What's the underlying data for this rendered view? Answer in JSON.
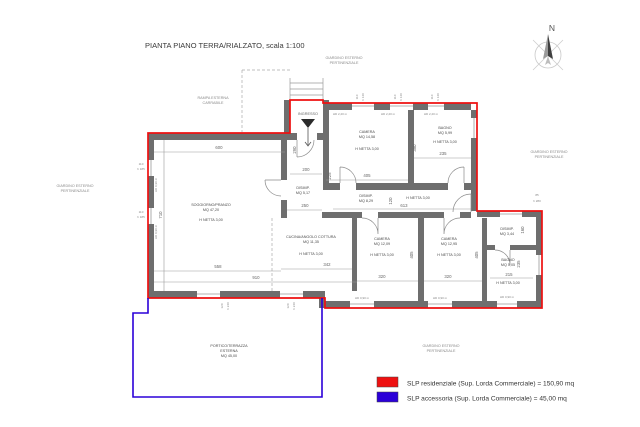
{
  "title": "PIANTA PIANO TERRA/RIALZATO, scala 1:100",
  "compass": {
    "n": "N"
  },
  "exterior": {
    "rampa": {
      "line1": "RAMPA ESTERNA",
      "line2": "CARRABILE"
    },
    "ingresso": "INGRESSO",
    "giardino": {
      "line1": "GIARDINO ESTERNO",
      "line2": "PERTINENZIALE"
    }
  },
  "rooms": {
    "soggiorno": {
      "name": "SOGGIORNO/PRANZO",
      "area": "MQ 47,20",
      "height": "H NETTA 3,00"
    },
    "cucina": {
      "name": "CUCINA/ANGOLO COTTURA",
      "area": "MQ 11,35",
      "height": "H NETTA 3,00"
    },
    "disimp1": {
      "name": "DISIMP.",
      "area": "MQ 5,17"
    },
    "camera_nord": {
      "name": "CAMERA",
      "area": "MQ 14,58",
      "height": "H NETTA 3,00"
    },
    "bagno_nord": {
      "name": "BAGNO",
      "area": "MQ 5,99",
      "height": "H NETTA 3,00"
    },
    "disimp2": {
      "name": "DISIMP.",
      "area": "MQ 8,29",
      "height": "H NETTA 3,00"
    },
    "camera_so": {
      "name": "CAMERA",
      "area": "MQ 12,09",
      "height": "H NETTA 3,00"
    },
    "camera_se": {
      "name": "CAMERA",
      "area": "MQ 12,95",
      "height": "H NETTA 3,00"
    },
    "disimp3": {
      "name": "DISIMP.",
      "area": "MQ 3,44"
    },
    "bagno_sud": {
      "name": "BAGNO",
      "area": "MQ 5,05",
      "height": "H NETTA 3,00"
    },
    "portico": {
      "line1": "PORTICO/TERRAZZA",
      "line2": "ESTERNA",
      "line3": "MQ 45,00"
    }
  },
  "dims": {
    "d600": "600",
    "d290": "290",
    "d200": "200",
    "d225": "225",
    "d710": "710",
    "d558": "558",
    "d910": "910",
    "d342": "342",
    "d250": "250",
    "d405": "405",
    "d350": "350",
    "d235": "235",
    "d613": "613",
    "d120": "120",
    "d320": "320",
    "d215": "215",
    "d160": "160",
    "d85": "85",
    "d85h": "h 280"
  },
  "win": {
    "top_w": "110",
    "top_h": "h 140",
    "left_w": "110",
    "left_h": "h 185",
    "door_w": "120",
    "door_h": "h 240",
    "sill_low": "HD 0,90 m",
    "sill_high": "HD 2,20 m"
  },
  "legend": {
    "items": [
      {
        "color": "#ee1111",
        "label": "SLP residenziale (Sup. Lorda Commerciale) = 150,90 mq"
      },
      {
        "color": "#2b00d8",
        "label": "SLP accessoria (Sup. Lorda Commerciale) = 45,00 mq"
      }
    ]
  }
}
